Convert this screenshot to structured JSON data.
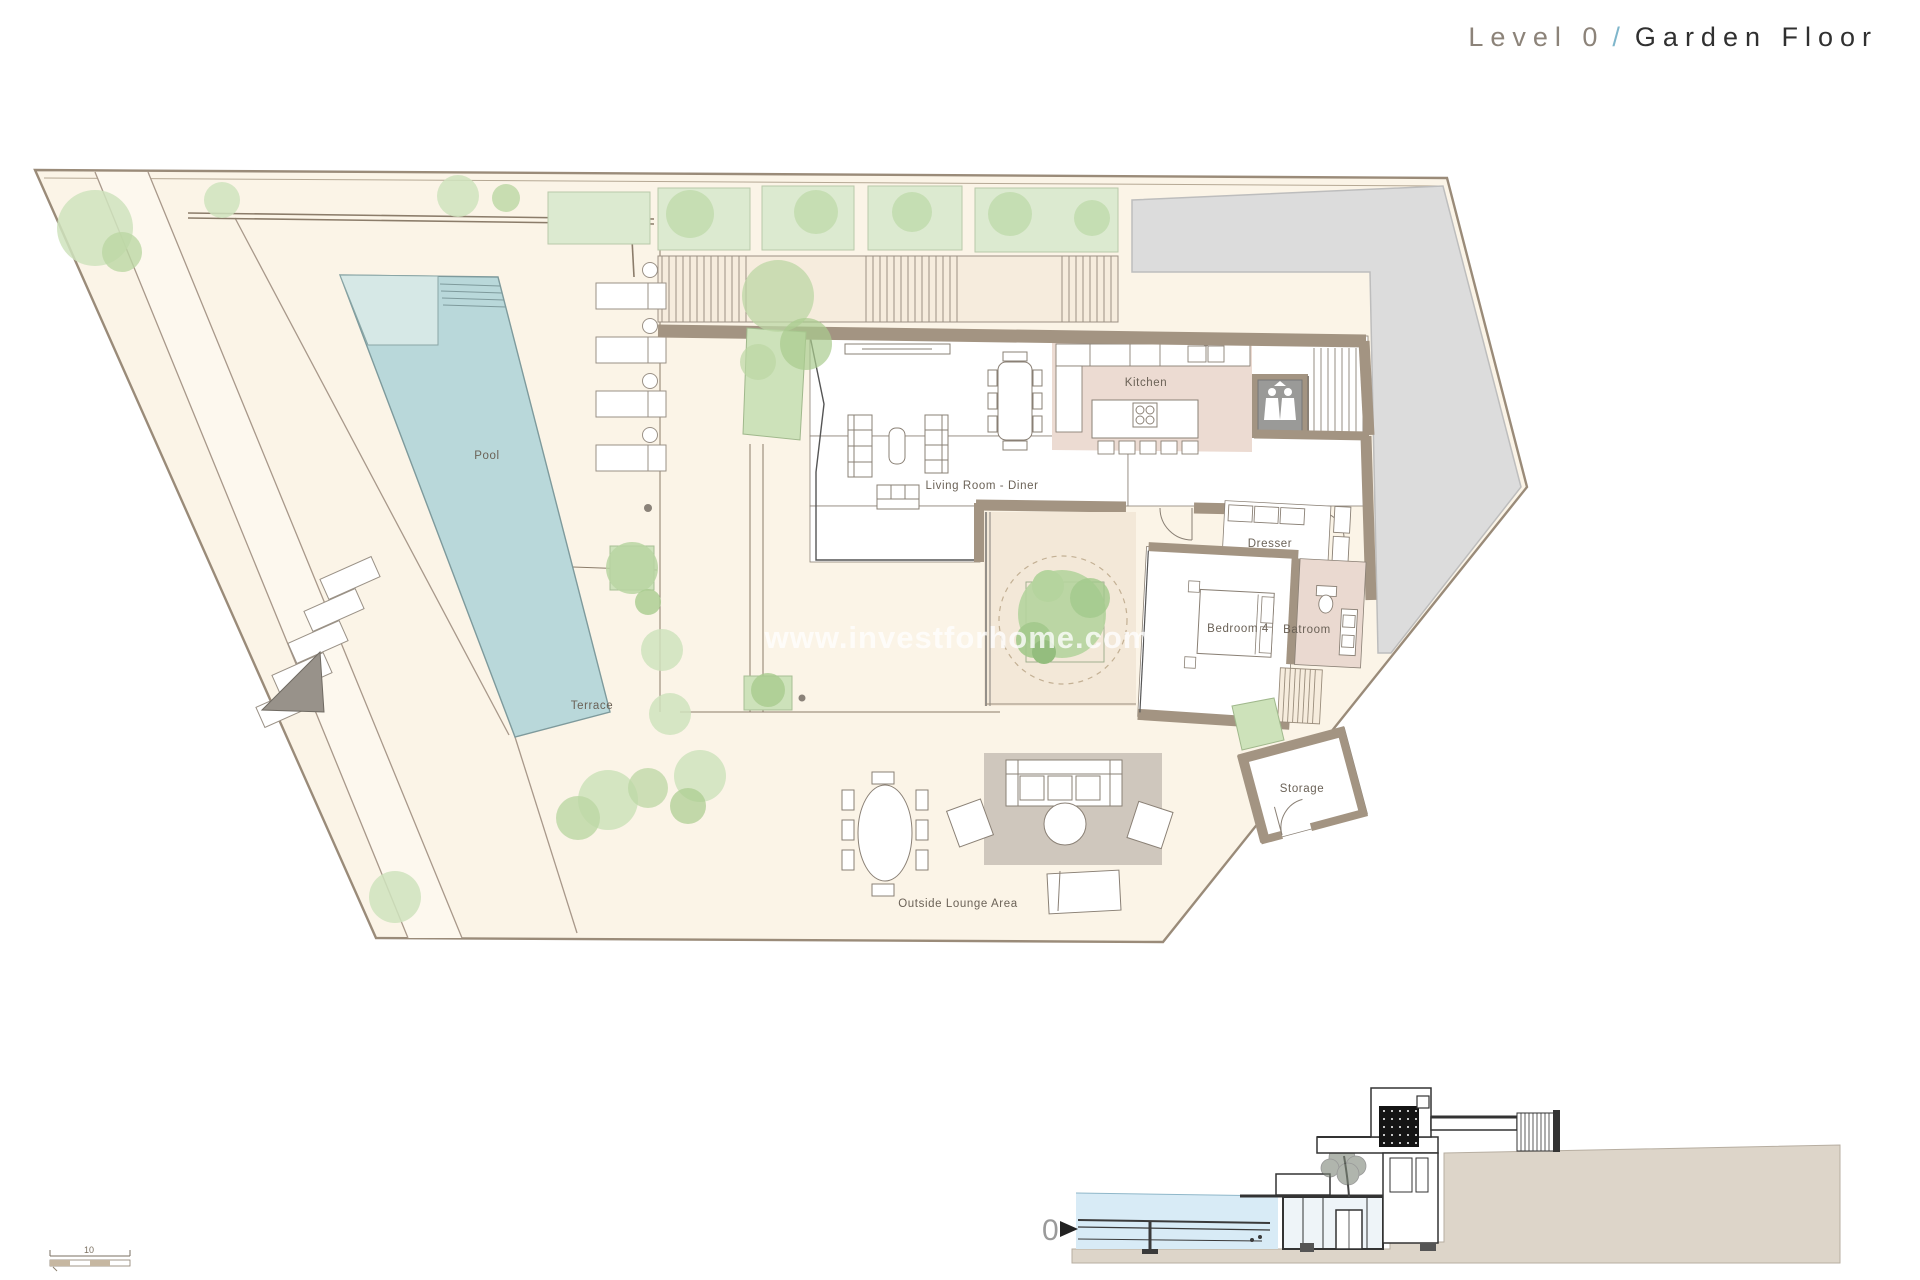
{
  "header": {
    "level": "Level 0",
    "separator": "/",
    "floor": "Garden Floor"
  },
  "watermark": "www.investforhome.com",
  "labels": {
    "pool": "Pool",
    "terrace": "Terrace",
    "living_room": "Living Room - Diner",
    "kitchen": "Kitchen",
    "dresser": "Dresser",
    "bedroom4": "Bedroom 4",
    "bathroom": "Batroom",
    "storage": "Storage",
    "outside_lounge": "Outside Lounge Area"
  },
  "section": {
    "level_marker": "0"
  },
  "scale_bar": {
    "length_label": "10"
  },
  "colors": {
    "accent_blue": "#7fb6cb",
    "plot_cream": "#fbf4e7",
    "pool_teal": "#b9d8da",
    "pool_shallow": "#d6e8e6",
    "vegetation_green": "#cfe3bd",
    "neighbor_gray": "#dcdcdc",
    "wall_tan": "#a39482",
    "kitchen_floor": "#ecdbd2",
    "patio_beige": "#f3e8d8",
    "rug_gray": "#ccc4bb",
    "water_blue": "#d8ebf6",
    "ground_gray": "#ddd5c9",
    "label_gray": "#6b6257"
  }
}
